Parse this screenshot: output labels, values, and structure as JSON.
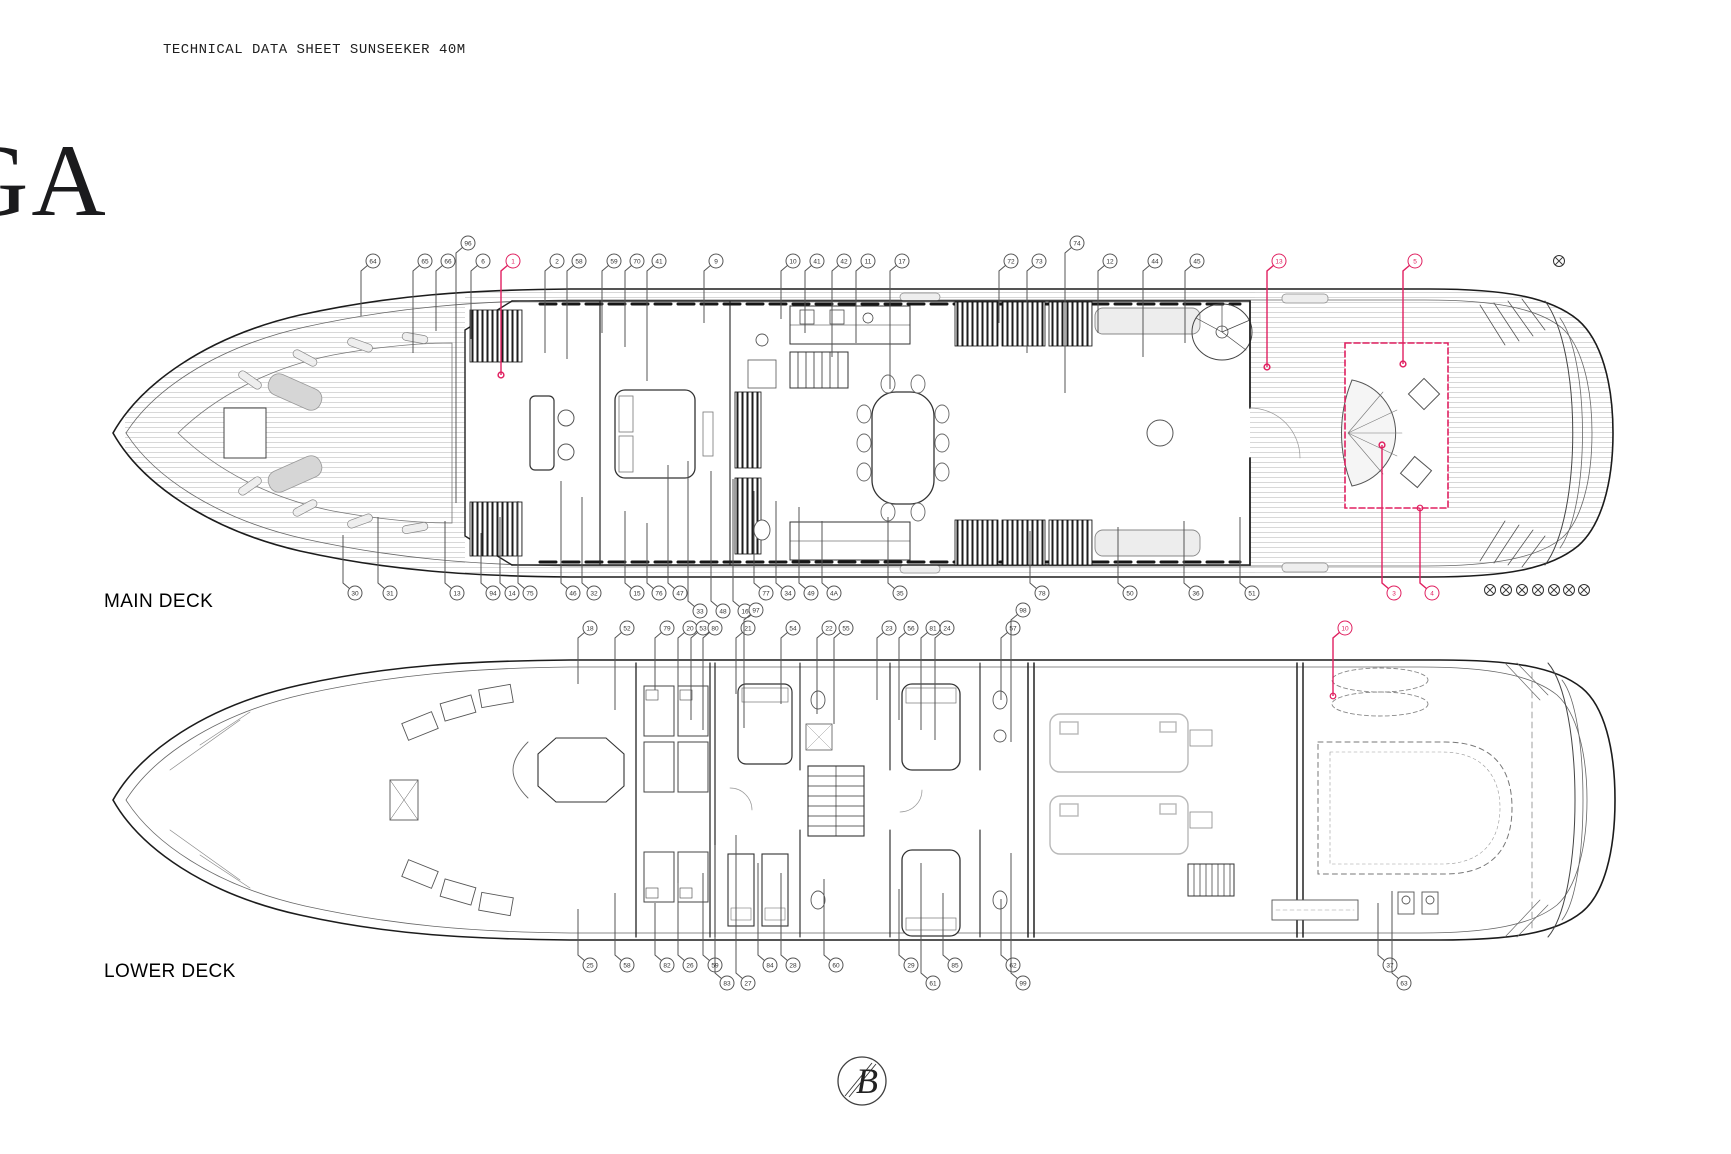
{
  "header": {
    "title": "TECHNICAL DATA SHEET SUNSEEKER 40M"
  },
  "watermark": {
    "text": "GA"
  },
  "deck_labels": {
    "main": "MAIN DECK",
    "lower": "LOWER DECK"
  },
  "logo": {
    "monogram": "B"
  },
  "colors": {
    "accent": "#E02060",
    "line": "#1C1C1C",
    "plank": "#D4D4D4",
    "gray": "#888888"
  },
  "highlight": {
    "rect": {
      "x": 1345,
      "y": 343,
      "w": 103,
      "h": 165
    }
  },
  "markers": {
    "top_right": {
      "x": 1559,
      "y": 261
    },
    "bottom_right_row": {
      "y": 590,
      "xs": [
        1490,
        1506,
        1522,
        1538,
        1554,
        1569,
        1584
      ]
    }
  },
  "callouts": {
    "main_top": {
      "y": 261,
      "dir": "down",
      "items": [
        [
          373,
          "64",
          55
        ],
        [
          425,
          "65",
          92
        ],
        [
          448,
          "66",
          70
        ],
        [
          468,
          "96",
          260,
          -18
        ],
        [
          483,
          "6",
          78
        ],
        [
          513,
          "1",
          114,
          0,
          "red"
        ],
        [
          557,
          "2",
          92
        ],
        [
          579,
          "58",
          98
        ],
        [
          614,
          "59",
          72
        ],
        [
          637,
          "70",
          86
        ],
        [
          659,
          "41",
          120
        ],
        [
          716,
          "9",
          62
        ],
        [
          793,
          "10",
          58
        ],
        [
          817,
          "41",
          72
        ],
        [
          844,
          "42",
          96
        ],
        [
          868,
          "11",
          82
        ],
        [
          902,
          "17",
          128
        ],
        [
          1011,
          "72",
          62
        ],
        [
          1039,
          "73",
          92
        ],
        [
          1077,
          "74",
          150,
          -18
        ],
        [
          1110,
          "12",
          72
        ],
        [
          1155,
          "44",
          96
        ],
        [
          1197,
          "45",
          82
        ],
        [
          1279,
          "13",
          106,
          0,
          "red"
        ],
        [
          1415,
          "5",
          103,
          0,
          "red"
        ]
      ]
    },
    "main_bottom": {
      "y": 593,
      "dir": "up",
      "items": [
        [
          355,
          "30",
          58
        ],
        [
          390,
          "31",
          76
        ],
        [
          457,
          "13",
          72
        ],
        [
          493,
          "94",
          60
        ],
        [
          512,
          "14",
          76
        ],
        [
          530,
          "75",
          92
        ],
        [
          573,
          "46",
          112
        ],
        [
          594,
          "32",
          96
        ],
        [
          637,
          "15",
          82
        ],
        [
          659,
          "76",
          70
        ],
        [
          680,
          "47",
          128
        ],
        [
          700,
          "33",
          150,
          18
        ],
        [
          723,
          "48",
          140,
          18
        ],
        [
          745,
          "16",
          132,
          18
        ],
        [
          766,
          "77",
          102
        ],
        [
          788,
          "34",
          92
        ],
        [
          811,
          "49",
          86
        ],
        [
          834,
          "4A",
          72
        ],
        [
          900,
          "35",
          76
        ],
        [
          1042,
          "78",
          62
        ],
        [
          1130,
          "50",
          66
        ],
        [
          1196,
          "36",
          72
        ],
        [
          1252,
          "51",
          76
        ],
        [
          1394,
          "3",
          148,
          0,
          "red"
        ],
        [
          1432,
          "4",
          85,
          0,
          "red"
        ]
      ]
    },
    "lower_top": {
      "y": 628,
      "dir": "down",
      "items": [
        [
          590,
          "18",
          56
        ],
        [
          627,
          "52",
          82
        ],
        [
          667,
          "79",
          62
        ],
        [
          690,
          "20",
          72
        ],
        [
          703,
          "53",
          92
        ],
        [
          715,
          "80",
          102
        ],
        [
          748,
          "21",
          66
        ],
        [
          756,
          "97",
          118,
          -18
        ],
        [
          793,
          "54",
          76
        ],
        [
          829,
          "22",
          86
        ],
        [
          846,
          "55",
          96
        ],
        [
          889,
          "23",
          72
        ],
        [
          911,
          "56",
          92
        ],
        [
          933,
          "81",
          102
        ],
        [
          947,
          "24",
          112
        ],
        [
          1013,
          "57",
          72
        ],
        [
          1023,
          "98",
          132,
          -18
        ],
        [
          1345,
          "10",
          68,
          0,
          "red"
        ]
      ]
    },
    "lower_bottom": {
      "y": 965,
      "dir": "up",
      "items": [
        [
          590,
          "25",
          56
        ],
        [
          627,
          "58",
          72
        ],
        [
          667,
          "82",
          62
        ],
        [
          690,
          "26",
          82
        ],
        [
          715,
          "59",
          92
        ],
        [
          727,
          "83",
          138,
          18
        ],
        [
          748,
          "27",
          148,
          18
        ],
        [
          770,
          "84",
          102
        ],
        [
          793,
          "28",
          92
        ],
        [
          836,
          "60",
          86
        ],
        [
          911,
          "29",
          76
        ],
        [
          933,
          "61",
          120,
          18
        ],
        [
          955,
          "85",
          72
        ],
        [
          1013,
          "62",
          66
        ],
        [
          1023,
          "99",
          130,
          18
        ],
        [
          1390,
          "37",
          62
        ],
        [
          1404,
          "63",
          92,
          18
        ]
      ]
    }
  }
}
